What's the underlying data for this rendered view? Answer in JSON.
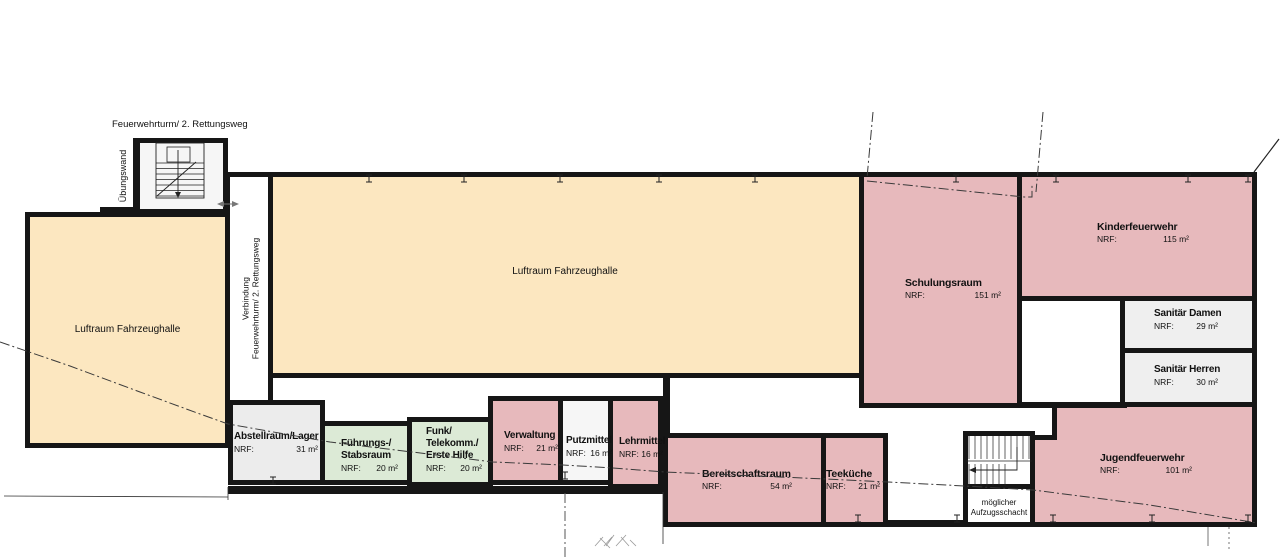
{
  "colors": {
    "hall_yellow": "#FCE7C0",
    "room_pink": "#E7B9BC",
    "room_green": "#DCEAD6",
    "room_gray": "#EFEFEF",
    "wall": "#161616"
  },
  "labels": {
    "feuerwehrturm": "Feuerwehrturm/ 2. Rettungsweg",
    "uebungswand": "Übungswand",
    "verbindung": {
      "line1": "Verbindung",
      "line2": "Feuerwehrturm/ 2. Rettungsweg"
    },
    "nrf": "NRF:"
  },
  "rooms": {
    "luftraum_left": {
      "name": "Luftraum Fahrzeughalle"
    },
    "luftraum_main": {
      "name": "Luftraum Fahrzeughalle"
    },
    "schulungsraum": {
      "name": "Schulungsraum",
      "area": "151 m²"
    },
    "kinderfeuerwehr": {
      "name": "Kinderfeuerwehr",
      "area": "115 m²"
    },
    "sanitaer_damen": {
      "name": "Sanitär Damen",
      "area": "29 m²"
    },
    "sanitaer_herren": {
      "name": "Sanitär Herren",
      "area": "30 m²"
    },
    "jugendfeuerwehr": {
      "name": "Jugendfeuerwehr",
      "area": "101 m²"
    },
    "abstellraum": {
      "name": "Abstellraum/Lager",
      "area": "31 m²"
    },
    "fuehrungsraum": {
      "line1": "Führungs-/",
      "line2": "Stabsraum",
      "area": "20 m²"
    },
    "funkraum": {
      "line1": "Funk/",
      "line2": "Telekomm./",
      "line3": "Erste Hilfe",
      "area": "20 m²"
    },
    "verwaltung": {
      "name": "Verwaltung",
      "area": "21 m²"
    },
    "putzmittel": {
      "name": "Putzmittel",
      "area": "16 m²"
    },
    "lehrmittel": {
      "name": "Lehrmittel",
      "area": "16 m²"
    },
    "bereitschaftsraum": {
      "name": "Bereitschaftsraum",
      "area": "54 m²"
    },
    "teekueche": {
      "name": "Teeküche",
      "area": "21 m²"
    },
    "aufzugsschacht": {
      "line1": "möglicher",
      "line2": "Aufzugsschacht"
    }
  }
}
